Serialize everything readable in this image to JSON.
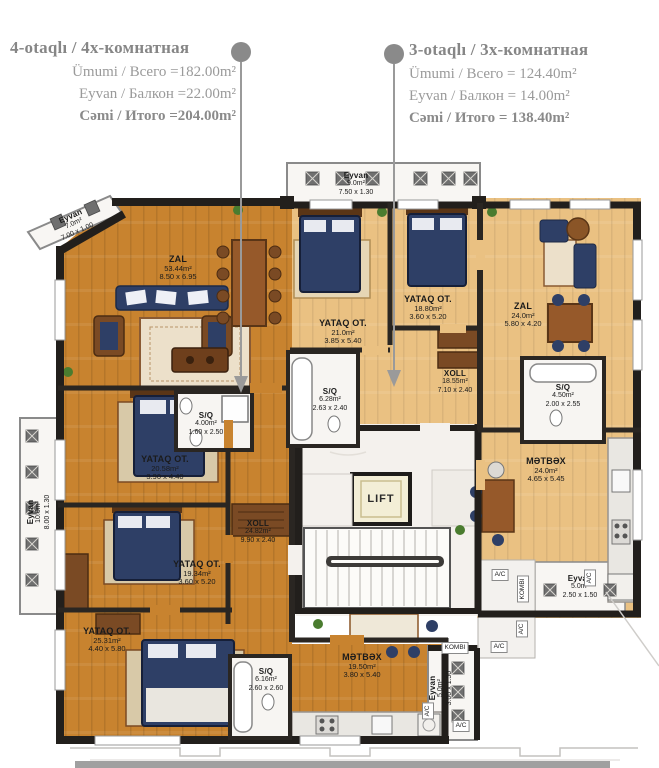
{
  "header": {
    "left": {
      "title": "4-otaqlı / 4х-комнатная",
      "rows": [
        "Ümumi / Всего =182.00m²",
        "Eyvan / Балкон =22.00m²",
        "Cəmi / Итого =204.00m²"
      ]
    },
    "right": {
      "title": "3-otaqlı / 3х-комнатная",
      "rows": [
        "Ümumi / Всего = 124.40m²",
        "Eyvan / Балкон = 14.00m²",
        "Cəmi / Итого = 138.40m²"
      ]
    }
  },
  "plan": {
    "apt4": {
      "zal": {
        "name": "ZAL",
        "area": "53.44m²",
        "dims": "8.50 x 6.95"
      },
      "yataq1": {
        "name": "YATAQ OT.",
        "area": "20.58m²",
        "dims": "3.90 x 4.40"
      },
      "sq1": {
        "name": "S/Q",
        "area": "4.00m²",
        "dims": "1.60 x 2.50"
      },
      "yataq2": {
        "name": "YATAQ OT.",
        "area": "19.34m²",
        "dims": "3.60 x 5.20"
      },
      "xoll": {
        "name": "XOLL",
        "area": "24.82m²",
        "dims": "9.90 x 2.40"
      },
      "yataq3": {
        "name": "YATAQ OT.",
        "area": "25.31m²",
        "dims": "4.40 x 5.80"
      },
      "sq2": {
        "name": "S/Q",
        "area": "6.16m²",
        "dims": "2.60 x 2.60"
      },
      "metbex": {
        "name": "MƏTBƏX",
        "area": "19.50m²",
        "dims": "3.80 x 5.40"
      },
      "eyvan_diag": {
        "name": "Eyvan",
        "area": "7.0m²",
        "dims": "7.00 x 1.00"
      },
      "eyvan_left": {
        "name": "Eyvan",
        "area": "10.0m²",
        "dims": "8.00 x 1.30"
      },
      "eyvan_bottom": {
        "name": "Eyvan",
        "area": "5.0m²",
        "dims": "3.00 x 1.50"
      }
    },
    "apt3": {
      "yataq1": {
        "name": "YATAQ OT.",
        "area": "21.0m²",
        "dims": "3.85 x 5.40"
      },
      "yataq2": {
        "name": "YATAQ OT.",
        "area": "18.80m²",
        "dims": "3.60 x 5.20"
      },
      "xoll": {
        "name": "XOLL",
        "area": "18.55m²",
        "dims": "7.10 x 2.40"
      },
      "sq1": {
        "name": "S/Q",
        "area": "6.28m²",
        "dims": "2.63 x 2.40"
      },
      "zal": {
        "name": "ZAL",
        "area": "24.0m²",
        "dims": "5.80 x 4.20"
      },
      "sq2": {
        "name": "S/Q",
        "area": "4.50m²",
        "dims": "2.00 x 2.55"
      },
      "metbex": {
        "name": "MƏTBƏX",
        "area": "24.0m²",
        "dims": "4.65 x 5.45"
      },
      "eyvan_top": {
        "name": "Eyvan",
        "area": "9.0m²",
        "dims": "7.50 x 1.30"
      },
      "eyvan_right": {
        "name": "Eyvan",
        "area": "5.0m²",
        "dims": "2.50 x 1.50"
      }
    },
    "labels": {
      "lift": "LIFT",
      "ac": "A/C",
      "kombi": "KOMBI"
    }
  },
  "colors": {
    "accent_gray": "#8f8f8f",
    "floor_apt4": "#c8832f",
    "floor_apt3": "#eac182",
    "wall": "#221f1c",
    "bed": "#2e3f66"
  }
}
